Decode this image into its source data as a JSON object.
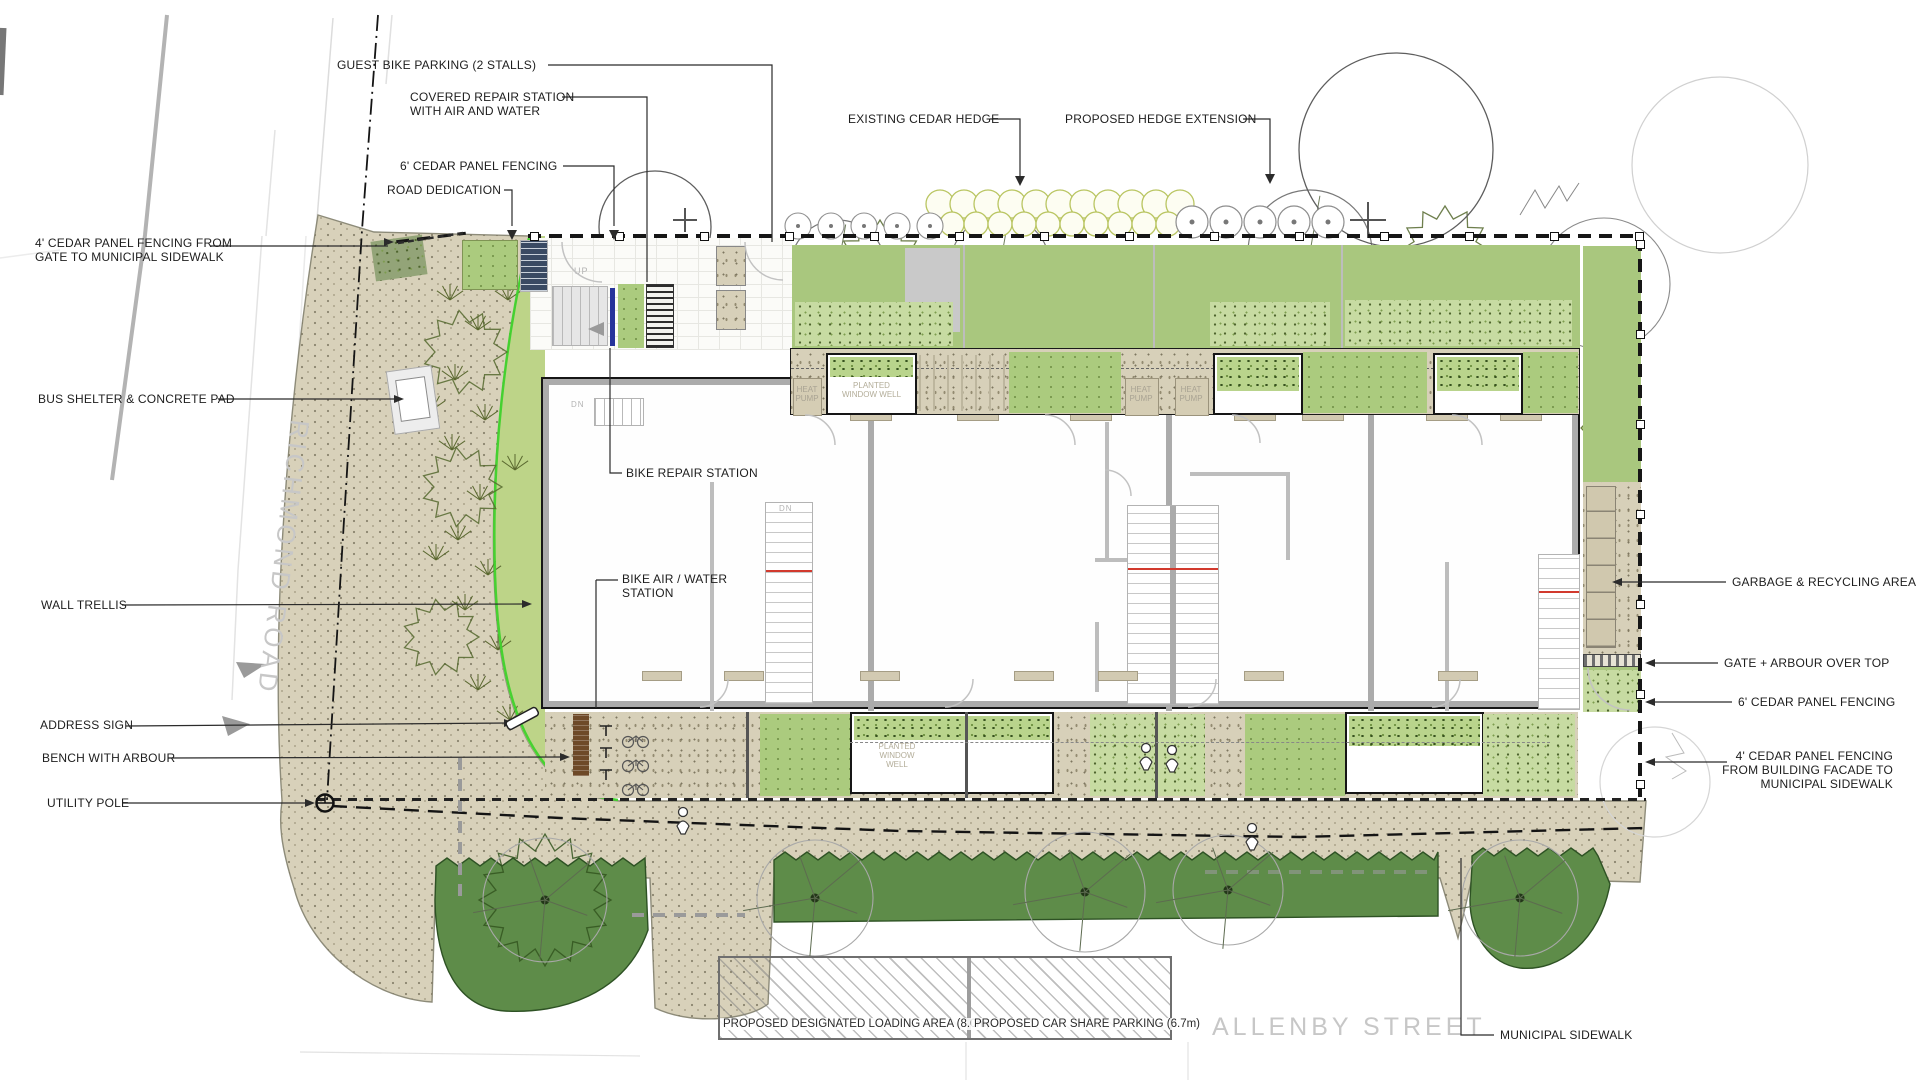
{
  "streets": {
    "richmond": "RICHMOND ROAD",
    "allenby": "ALLENBY STREET"
  },
  "labels": {
    "guest_bike": "GUEST BIKE PARKING (2 STALLS)",
    "covered_repair": "COVERED REPAIR STATION\nWITH AIR AND WATER",
    "cedar6_top": "6' CEDAR PANEL FENCING",
    "road_dedication": "ROAD DEDICATION",
    "cedar4_left": "4' CEDAR PANEL FENCING FROM\nGATE TO MUNICIPAL SIDEWALK",
    "bus_shelter": "BUS SHELTER & CONCRETE PAD",
    "wall_trellis": "WALL TRELLIS",
    "address_sign": "ADDRESS SIGN",
    "bench_arbour": "BENCH WITH ARBOUR",
    "utility_pole": "UTILITY POLE",
    "existing_hedge": "EXISTING CEDAR HEDGE",
    "proposed_hedge": "PROPOSED HEDGE EXTENSION",
    "bike_repair": "BIKE REPAIR STATION",
    "bike_air": "BIKE AIR / WATER\nSTATION",
    "garbage": "GARBAGE & RECYCLING AREA",
    "gate_arbour": "GATE + ARBOUR OVER TOP",
    "cedar6_right": "6' CEDAR PANEL FENCING",
    "cedar4_right": "4' CEDAR PANEL FENCING\nFROM BUILDING FACADE TO\nMUNICIPAL SIDEWALK",
    "municipal_sidewalk": "MUNICIPAL SIDEWALK",
    "loading_area": "PROPOSED DESIGNATED LOADING AREA (8.0m)",
    "car_share": "PROPOSED CAR SHARE PARKING (6.7m)"
  },
  "plan_texts": {
    "heat_pump": "HEAT\nPUMP",
    "planted_window_well_2line": "PLANTED\nWINDOW WELL",
    "planted_window_well_3line": "PLANTED\nWINDOW\nWELL",
    "up": "UP",
    "dn": "DN"
  },
  "colors": {
    "sidewalk_tan": "#d7d0b9",
    "garden_light_green": "#bdd488",
    "yard_green": "#a9c77e",
    "lawn_dark_green": "#5e8c49",
    "building_wall_gray": "#ababab",
    "accent_blue": "#26339b",
    "accent_red": "#d23a2e",
    "property_green_line": "#3fd22b",
    "street_text_gray": "#c7c7c7"
  }
}
